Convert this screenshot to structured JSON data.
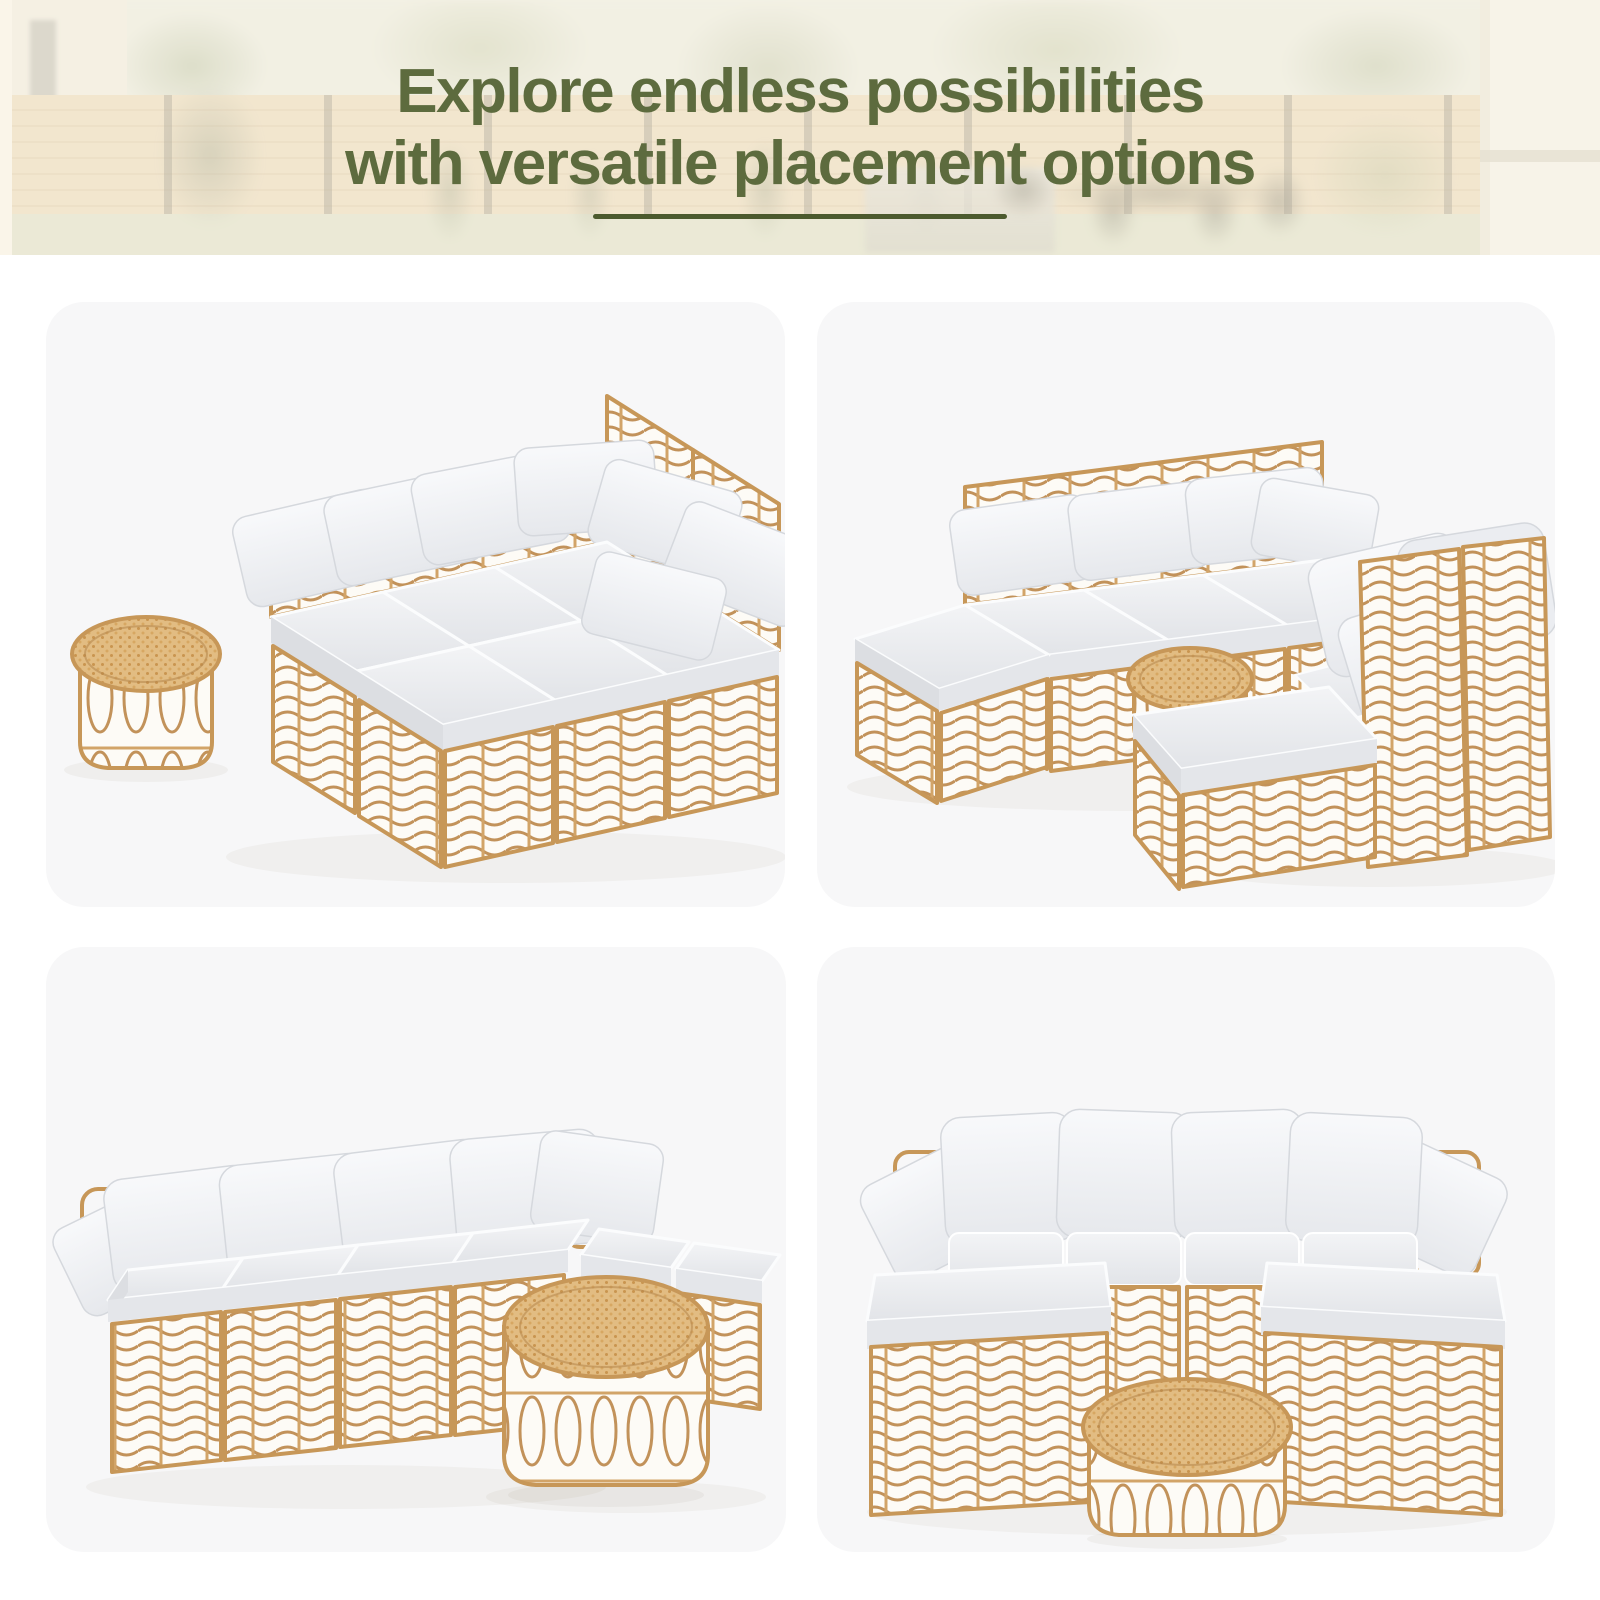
{
  "banner": {
    "title_line1": "Explore endless possibilities",
    "title_line2": "with versatile placement options",
    "title_color": "#5d6b3e",
    "divider_color": "#4c5a2e"
  },
  "palette": {
    "page_background": "#ffffff",
    "card_background": "#f7f7f8",
    "rattan_frame": "#c79758",
    "rattan_light": "#e2bc82",
    "cushion_gray": "#e9ebee",
    "pillow_white": "#f4f5f7"
  },
  "gallery": {
    "items": [
      {
        "id": "daybed",
        "label": "Daybed layout: six wicker modules joined into a large daybed with round side table"
      },
      {
        "id": "conversation",
        "label": "Conversation layout: three-seat sofa with ottoman facing two chairs and ottoman around a round side table"
      },
      {
        "id": "l-sectional",
        "label": "L-shaped sectional layout with ottomans and round rattan coffee table"
      },
      {
        "id": "u-sectional",
        "label": "U-shaped sectional layout with two chaises and round rattan coffee table"
      }
    ]
  }
}
